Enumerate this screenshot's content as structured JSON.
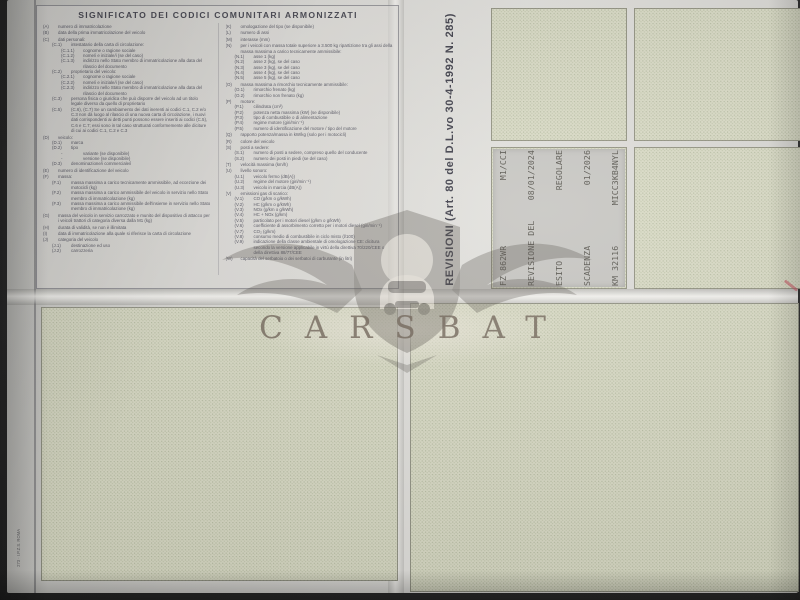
{
  "colors": {
    "paper": "#d9d8d4",
    "box_fill": "#dadbc6",
    "box_dot": "#b7bda2",
    "ink": "#565662",
    "stamp_bg": "#c7c6c2",
    "stamp_ink": "#58564f",
    "watermark": "#6e6255",
    "red_mark": "#c64655"
  },
  "left_panel": {
    "title": "SIGNIFICATO DEI CODICI COMUNITARI ARMONIZZATI",
    "col1": [
      {
        "ind": 0,
        "code": "(A)",
        "text": "numero di immatricolazione"
      },
      {
        "ind": 0,
        "code": "(B)",
        "text": "data della prima immatricolazione del veicolo"
      },
      {
        "ind": 0,
        "code": "(C)",
        "text": "dati personali:"
      },
      {
        "ind": 1,
        "code": "(C.1)",
        "text": "intestatario della carta di circolazione:"
      },
      {
        "ind": 2,
        "code": "(C.1.1)",
        "text": "cognome o ragione sociale"
      },
      {
        "ind": 2,
        "code": "(C.1.2)",
        "text": "nome/i e iniziale/i (se del caso)"
      },
      {
        "ind": 2,
        "code": "(C.1.3)",
        "text": "indirizzo nello Stato membro di immatricolazione alla data del rilascio del documento"
      },
      {
        "ind": 1,
        "code": "(C.2)",
        "text": "proprietario del veicolo:"
      },
      {
        "ind": 2,
        "code": "(C.2.1)",
        "text": "cognome o ragione sociale"
      },
      {
        "ind": 2,
        "code": "(C.2.2)",
        "text": "nome/i e iniziale/i (se del caso)"
      },
      {
        "ind": 2,
        "code": "(C.2.3)",
        "text": "indirizzo nello Stato membro di immatricolazione alla data del rilascio del documento"
      },
      {
        "ind": 1,
        "code": "(C.3)",
        "text": "persona fisica o giuridica che può disporre del veicolo ad un titolo legale diverso da quello di proprietario"
      },
      {
        "ind": 1,
        "code": "(C.5)",
        "text": "(C.6), (C.7) Se un cambiamento dei dati inerenti ai codici C.1, C.2 e/o C.3 non dà luogo al rilascio di una nuova carta di circolazione, i nuovi dati corrispondenti ai detti punti possono essere inseriti ai codici (C.5), C.6 e C.7; essi sono in tal caso strutturati conformemente alle diciture di cui ai codici C.1, C.2 e C.3"
      },
      {
        "ind": 0,
        "code": "(D)",
        "text": "veicolo:"
      },
      {
        "ind": 1,
        "code": "(D.1)",
        "text": "marca"
      },
      {
        "ind": 1,
        "code": "(D.2)",
        "text": "tipo"
      },
      {
        "ind": 2,
        "code": "-",
        "text": "variante (se disponibile)"
      },
      {
        "ind": 2,
        "code": "-",
        "text": "versione (se disponibile)"
      },
      {
        "ind": 1,
        "code": "(D.3)",
        "text": "denominazione/i commerciale/i"
      },
      {
        "ind": 0,
        "code": "(E)",
        "text": "numero di identificazione del veicolo"
      },
      {
        "ind": 0,
        "code": "(F)",
        "text": "massa:"
      },
      {
        "ind": 1,
        "code": "(F.1)",
        "text": "massa massima a carico tecnicamente ammissibile, ad eccezione dei motocicli (kg)"
      },
      {
        "ind": 1,
        "code": "(F.2)",
        "text": "massa massima a carico ammissibile del veicolo in servizio nello Stato membro di immatricolazione (kg)"
      },
      {
        "ind": 1,
        "code": "(F.3)",
        "text": "massa massima a carico ammissibile dell'insieme in servizio nello Stato membro di immatricolazione (kg)"
      },
      {
        "ind": 0,
        "code": "(G)",
        "text": "massa del veicolo in servizio carrozzato e munito del dispositivo di attacco per i veicoli trattori di categoria diversa dalla M1 (kg)"
      },
      {
        "ind": 0,
        "code": "(H)",
        "text": "durata di validità, se non è illimitata"
      },
      {
        "ind": 0,
        "code": "(I)",
        "text": "data di immatricolazione alla quale si riferisce la carta di circolazione"
      },
      {
        "ind": 0,
        "code": "(J)",
        "text": "categoria del veicolo"
      },
      {
        "ind": 1,
        "code": "(J.1)",
        "text": "destinazione ed uso"
      },
      {
        "ind": 1,
        "code": "(J.2)",
        "text": "carrozzeria"
      }
    ],
    "col2": [
      {
        "ind": 0,
        "code": "(K)",
        "text": "omologazione del tipo (se disponibile)"
      },
      {
        "ind": 0,
        "code": "(L)",
        "text": "numero di assi"
      },
      {
        "ind": 0,
        "code": "(M)",
        "text": "interasse (mm)"
      },
      {
        "ind": 0,
        "code": "(N)",
        "text": "per i veicoli con massa totale superiore a 3.500 kg ripartizione tra gli assi della massa massima a carico tecnicamente ammissibile:"
      },
      {
        "ind": 1,
        "code": "(N.1)",
        "text": "asse 1 (kg)"
      },
      {
        "ind": 1,
        "code": "(N.2)",
        "text": "asse 2 (kg), se del caso"
      },
      {
        "ind": 1,
        "code": "(N.3)",
        "text": "asse 3 (kg), se del caso"
      },
      {
        "ind": 1,
        "code": "(N.4)",
        "text": "asse 4 (kg), se del caso"
      },
      {
        "ind": 1,
        "code": "(N.5)",
        "text": "asse 5 (kg), se del caso"
      },
      {
        "ind": 0,
        "code": "(O)",
        "text": "massa massima a rimorchio tecnicamente ammissibile:"
      },
      {
        "ind": 1,
        "code": "(O.1)",
        "text": "rimorchio frenato (kg)"
      },
      {
        "ind": 1,
        "code": "(O.2)",
        "text": "rimorchio non frenato (kg)"
      },
      {
        "ind": 0,
        "code": "(P)",
        "text": "motore:"
      },
      {
        "ind": 1,
        "code": "(P.1)",
        "text": "cilindrata (cm³)"
      },
      {
        "ind": 1,
        "code": "(P.2)",
        "text": "potenza netta massima (kW) (se disponibile)"
      },
      {
        "ind": 1,
        "code": "(P.3)",
        "text": "tipo di combustibile o di alimentazione"
      },
      {
        "ind": 1,
        "code": "(P.4)",
        "text": "regime motore (giri/min⁻¹)"
      },
      {
        "ind": 1,
        "code": "(P.5)",
        "text": "numero di identificazione del motore / tipo del motore"
      },
      {
        "ind": 0,
        "code": "(Q)",
        "text": "rapporto potenza/massa in kW/kg (solo per i motocicli)"
      },
      {
        "ind": 0,
        "code": "(R)",
        "text": "colore del veicolo"
      },
      {
        "ind": 0,
        "code": "(S)",
        "text": "posti a sedere:"
      },
      {
        "ind": 1,
        "code": "(S.1)",
        "text": "numero di posti a sedere, compreso quello del conducente"
      },
      {
        "ind": 1,
        "code": "(S.2)",
        "text": "numero dei posti in piedi (se del caso)"
      },
      {
        "ind": 0,
        "code": "(T)",
        "text": "velocità massima (km/h)"
      },
      {
        "ind": 0,
        "code": "(U)",
        "text": "livello sonoro:"
      },
      {
        "ind": 1,
        "code": "(U.1)",
        "text": "veicolo fermo (dB(A))"
      },
      {
        "ind": 1,
        "code": "(U.2)",
        "text": "regime del motore (giri/min⁻¹)"
      },
      {
        "ind": 1,
        "code": "(U.3)",
        "text": "veicolo in marcia (dB(A))"
      },
      {
        "ind": 0,
        "code": "(V)",
        "text": "emissioni gas di scarico:"
      },
      {
        "ind": 1,
        "code": "(V.1)",
        "text": "CO (g/km o g/kWh)"
      },
      {
        "ind": 1,
        "code": "(V.2)",
        "text": "HC (g/km o g/kWh)"
      },
      {
        "ind": 1,
        "code": "(V.3)",
        "text": "NOx (g/km o g/kWh)"
      },
      {
        "ind": 1,
        "code": "(V.4)",
        "text": "HC + NOx (g/km)"
      },
      {
        "ind": 1,
        "code": "(V.5)",
        "text": "particolato per i motori diesel (g/km o g/kWh)"
      },
      {
        "ind": 1,
        "code": "(V.6)",
        "text": "coefficiente di assorbimento corretto per i motori diesel (giri/min⁻¹)"
      },
      {
        "ind": 1,
        "code": "(V.7)",
        "text": "CO₂ (g/km)"
      },
      {
        "ind": 1,
        "code": "(V.8)",
        "text": "consumo medio di combustibile in ciclo misto (l/100)"
      },
      {
        "ind": 1,
        "code": "(V.9)",
        "text": "indicazione della classe ambientale di omologazione CE: dicitura secondo la versione applicabile in virtù della direttiva 70/220/CEE o della direttiva 88/77/CEE"
      },
      {
        "ind": 0,
        "code": "(W)",
        "text": "capacità del serbatoio o dei serbatoi di carburante (in litri)"
      }
    ]
  },
  "revisions": {
    "label": "REVISIONI (Art. 80 del D.L.vo 30-4-1992 N. 285)",
    "stamp": {
      "lines": [
        {
          "l": "FZ 862WR",
          "r": "M1/CCI"
        },
        {
          "l": "REVISIONE DEL",
          "r": "08/01/2024"
        },
        {
          "l": "ESITO",
          "r": "REGOLARE"
        },
        {
          "l": "SCADENZA",
          "r": "01/2026"
        },
        {
          "l": "KM 32116",
          "r": "MICC3KB4NYL"
        }
      ]
    }
  },
  "watermark": {
    "text": "CARSBAT"
  },
  "print_code": "273 · I.P.Z.S. ROMA"
}
